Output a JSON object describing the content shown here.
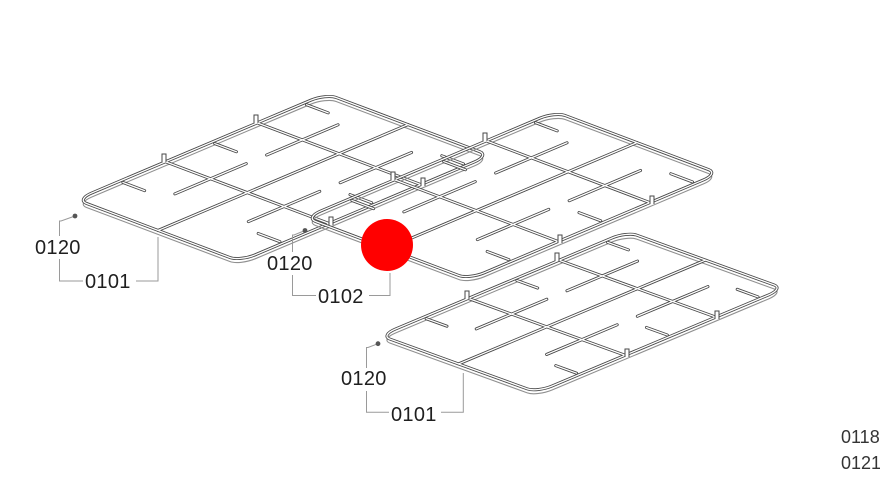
{
  "diagram": {
    "type": "exploded-parts-diagram",
    "subject": "gas hob pan support grates"
  },
  "callouts": [
    {
      "id": "left",
      "clip_ref": "0120",
      "part_ref": "0101"
    },
    {
      "id": "middle",
      "clip_ref": "0120",
      "part_ref": "0102"
    },
    {
      "id": "bottom",
      "clip_ref": "0120",
      "part_ref": "0101"
    }
  ],
  "edge_labels": {
    "line1": "0118",
    "line2": "0121"
  },
  "marker": {
    "color": "#ff0000"
  },
  "artwork": {
    "line_color": "#474747",
    "leader_color": "#9a9a9a"
  }
}
